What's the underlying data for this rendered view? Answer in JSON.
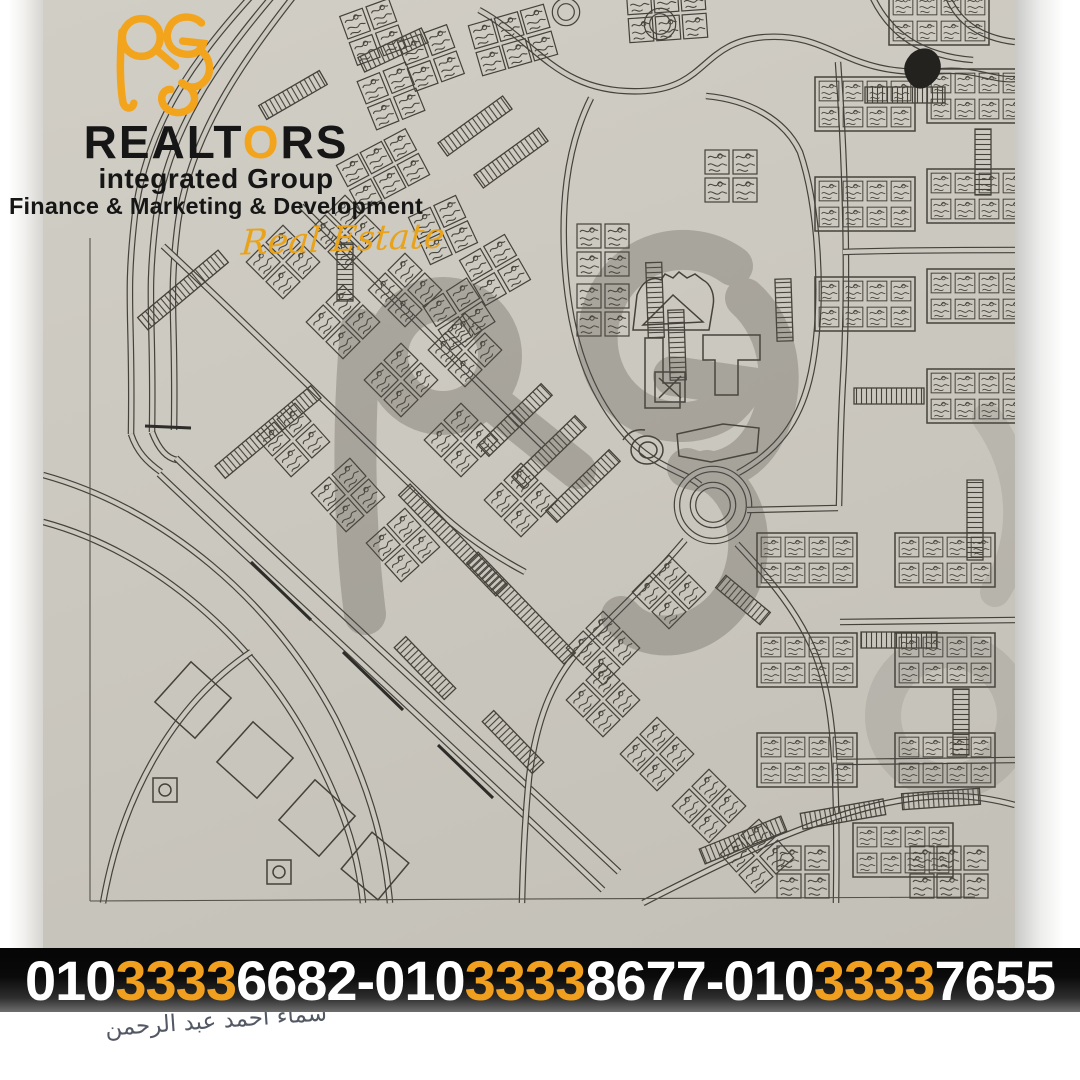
{
  "brand": {
    "monogram": "RG",
    "name_left": "REALT",
    "name_o": "O",
    "name_right": "RS",
    "subtitle": "integrated Group",
    "tagline": "Finance & Marketing & Development",
    "script": "Real Estate",
    "accent_color": "#F2A41D",
    "ink_color": "#161616"
  },
  "phone_bar": {
    "background": "#000000",
    "text_color": "#FFFFFF",
    "accent_color": "#F0A01E",
    "separator": "-",
    "numbers": [
      {
        "prefix": "010",
        "highlight": "3333",
        "suffix": "6682"
      },
      {
        "prefix": "010",
        "highlight": "3333",
        "suffix": "8677"
      },
      {
        "prefix": "010",
        "highlight": "3333",
        "suffix": "7655"
      }
    ]
  },
  "handwriting": {
    "text": "سماء احمد عبد الرحمن",
    "color": "#3c4150"
  },
  "map": {
    "paper_color": "#cbc8bf",
    "ink_color": "#45423b",
    "watermark_color": "#56534b"
  }
}
